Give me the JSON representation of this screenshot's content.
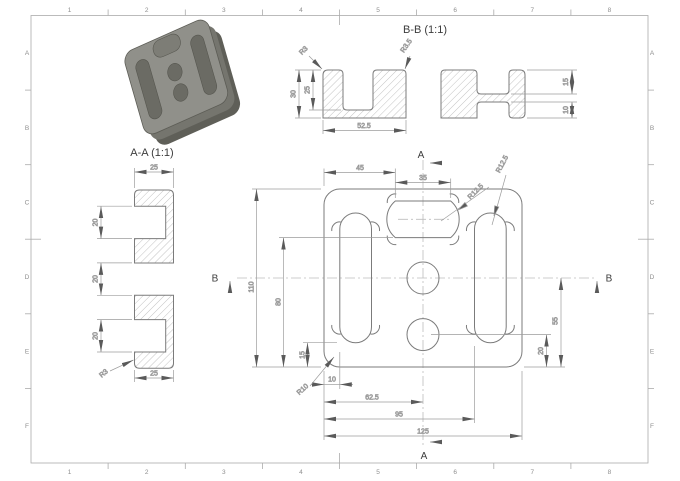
{
  "colors": {
    "paper": "#ffffff",
    "line": "#7b7b7b",
    "dim": "#9c9c9c",
    "centerline": "#bdbdbd",
    "text": "#4f4f4f",
    "title_text": "#3c3c3c",
    "frame_text": "#8f8f8f",
    "frame_line": "#ababab",
    "hatch": "#9a9a9a",
    "part_top": "#90908a",
    "part_side": "#75756e",
    "part_dark": "#5f5f58",
    "part_recess": "#6b6b64",
    "part_notch": "#7d7d76"
  },
  "frame": {
    "columns": [
      "1",
      "2",
      "3",
      "4",
      "5",
      "6",
      "7",
      "8"
    ],
    "rows": [
      "A",
      "B",
      "C",
      "D",
      "E",
      "F"
    ]
  },
  "section_aa": {
    "title": "A-A (1:1)",
    "dim_width_top": "25",
    "dim_width_bottom": "25",
    "dim_notch_top": "20",
    "dim_gap_middle": "20",
    "dim_notch_bottom": "20",
    "radius_corner": "R3"
  },
  "section_bb": {
    "title": "B-B (1:1)",
    "dim_height": "30",
    "dim_pocket_depth": "25",
    "dim_to_hole": "52.5",
    "radius_corner": "R3",
    "radius_fillet": "R3.5",
    "dim_top_web": "15",
    "dim_bottom_web": "10"
  },
  "plan": {
    "mark_a": "A",
    "mark_b": "B",
    "dim_pocket_offset": "45",
    "dim_pocket_width": "35",
    "dim_height": "110",
    "dim_pocket_bottom": "80",
    "dim_slot_bottom": "15",
    "dim_slot_offset": "10",
    "radius_corner": "R10",
    "dim_to_center": "62.5",
    "dim_to_right_slot": "95",
    "dim_width": "125",
    "dim_center_height": "55",
    "dim_hole_height": "20",
    "radius_pocket": "R12.5",
    "radius_slot": "R12.5"
  }
}
